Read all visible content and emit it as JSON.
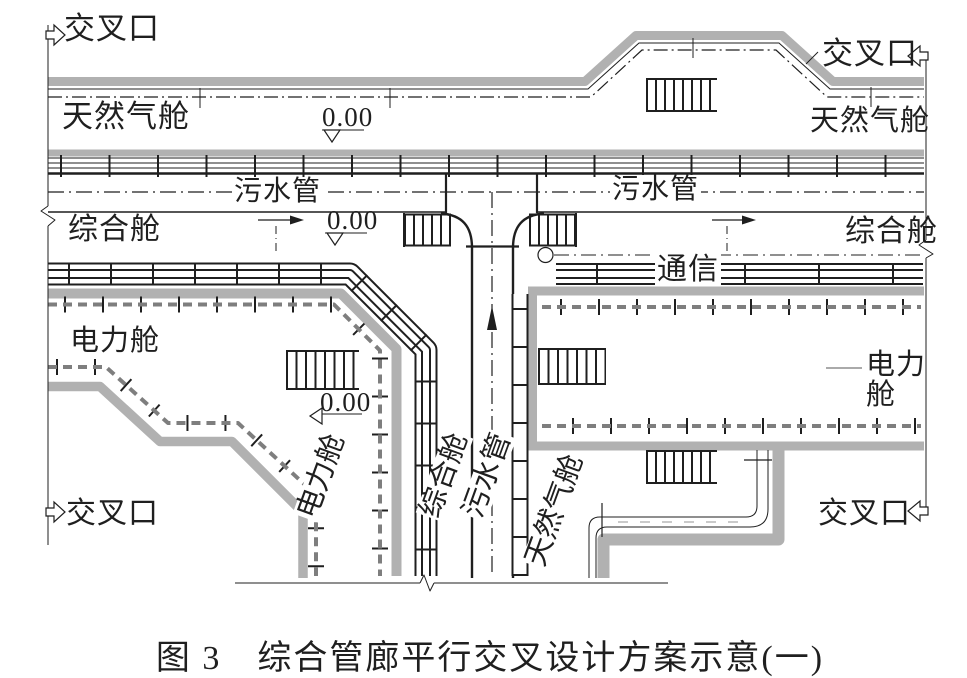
{
  "labels": {
    "intersection": "交叉口",
    "gas": "天然气舱",
    "sewage": "污水管",
    "utility": "综合舱",
    "power": "电力舱",
    "comm": "通信",
    "elevation": "0.00"
  },
  "caption": "图 3　综合管廊平行交叉设计方案示意(一)",
  "icons": {
    "entry_arrows": "hollow-arrow",
    "flow_arrows": "filled-arrow",
    "elevation_marker": "open-triangle",
    "node_circle": "circle"
  },
  "colors": {
    "ink": "#1f1f1f",
    "wall_gray": "#b1b1b1",
    "cable_dash_gray": "#7e7e7e",
    "paper": "#ffffff"
  }
}
